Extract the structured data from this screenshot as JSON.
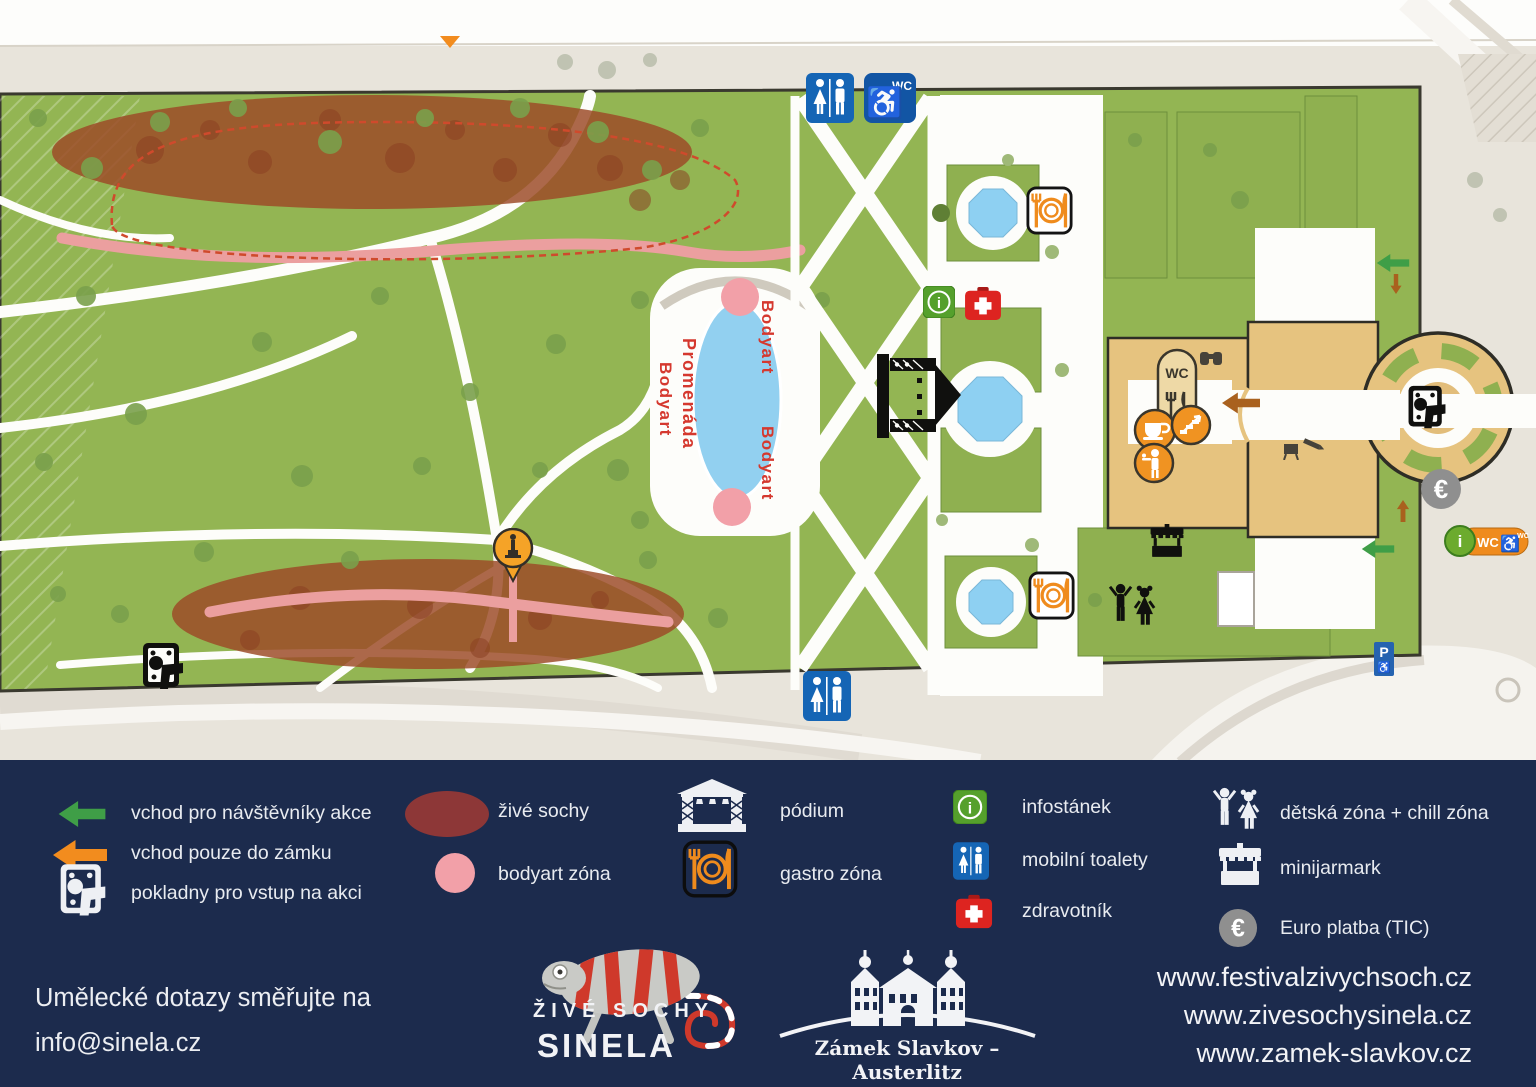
{
  "map": {
    "labels": {
      "promenada": "Promenáda",
      "bodyart": "Bodyart",
      "wc": "WC",
      "euro_symbol": "€",
      "parking": "P",
      "info_letter": "i"
    },
    "icons": {
      "wheelchair": "♿"
    }
  },
  "legend": {
    "items": [
      {
        "id": "entry-visitors",
        "label": "vchod pro návštěvníky akce"
      },
      {
        "id": "entry-castle-only",
        "label": "vchod pouze do zámku"
      },
      {
        "id": "ticket-offices",
        "label": "pokladny pro vstup na akci"
      },
      {
        "id": "living-statues",
        "label": "živé sochy"
      },
      {
        "id": "bodyart-zone",
        "label": "bodyart zóna"
      },
      {
        "id": "stage",
        "label": "pódium"
      },
      {
        "id": "gastro-zone",
        "label": "gastro zóna"
      },
      {
        "id": "info-stand",
        "label": "infostánek"
      },
      {
        "id": "mobile-toilets",
        "label": "mobilní toalety"
      },
      {
        "id": "medic",
        "label": "zdravotník"
      },
      {
        "id": "kids-zone",
        "label": "dětská zóna + chill zóna"
      },
      {
        "id": "mini-market",
        "label": "minijarmark"
      },
      {
        "id": "euro-payment",
        "label": "Euro platba (TIC)"
      }
    ]
  },
  "footer": {
    "contact_line1": "Umělecké dotazy směřujte na",
    "contact_line2": "info@sinela.cz",
    "sinela_logo_line1": "ŽIVÉ SOCHY",
    "sinela_logo_line2": "SINELA",
    "castle_logo_caption": "Zámek Slavkov – Austerlitz",
    "urls": [
      "www.festivalzivychsoch.cz",
      "www.zivesochysinela.cz",
      "www.zamek-slavkov.cz"
    ]
  },
  "colors": {
    "legend_bg": "#1c2b4d",
    "grass": "#93b553",
    "hedge": "#8fb050",
    "outside": "#e8e4db",
    "castle_tan": "#e6c37f",
    "pond_blue": "#92d0f0",
    "living_statues_zone": "#9c4b27",
    "living_statues_legend": "#8d3737",
    "bodyart_pink": "#f2a0a8",
    "entry_green": "#3f9e47",
    "entry_orange": "#f28c1e",
    "wc_blue": "#1565b5",
    "info_green": "#55a02c",
    "medic_red": "#dd2420",
    "euro_gray": "#8f8f8f",
    "map_red_text": "#d5382e"
  }
}
